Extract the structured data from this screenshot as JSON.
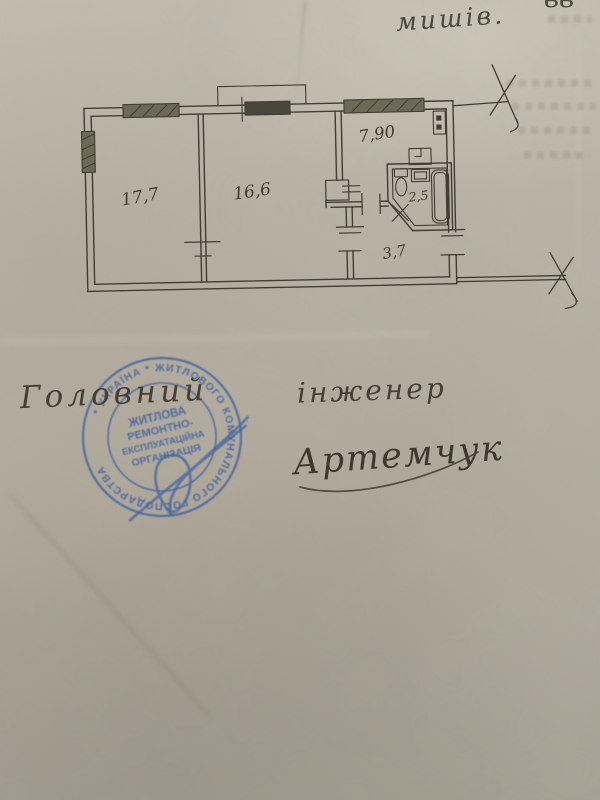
{
  "page": {
    "top_annotation": "мишів.",
    "top_annotation_partial": "вв"
  },
  "floor_plan": {
    "rooms": [
      {
        "name": "room-1",
        "area_label": "17,7"
      },
      {
        "name": "room-2",
        "area_label": "16,6"
      },
      {
        "name": "kitchen",
        "area_label": "7,90"
      },
      {
        "name": "bathroom",
        "area_label": "2,5"
      },
      {
        "name": "hallway",
        "area_label": "3,7"
      }
    ]
  },
  "signature_block": {
    "title_word_1": "Головний",
    "title_word_2": "інженер",
    "signature_name": "Артемчук"
  },
  "stamp": {
    "ring_text": "* УКРАЇНА * ЖИТЛОВОГО КОМУНАЛЬНОГО ГОСПОДАРСТВА",
    "center_lines": [
      "ЖИТЛОВА",
      "РЕМОНТНО-",
      "ЕКСПЛУАТАЦІЙНА",
      "ОРГАНІЗАЦІЯ"
    ],
    "ink_color": "#3d5fa3"
  },
  "colors": {
    "paper_light": "#c2bbad",
    "paper_dark": "#a39d8f",
    "ink": "#433c31",
    "stamp_blue": "#3d5fa3"
  }
}
